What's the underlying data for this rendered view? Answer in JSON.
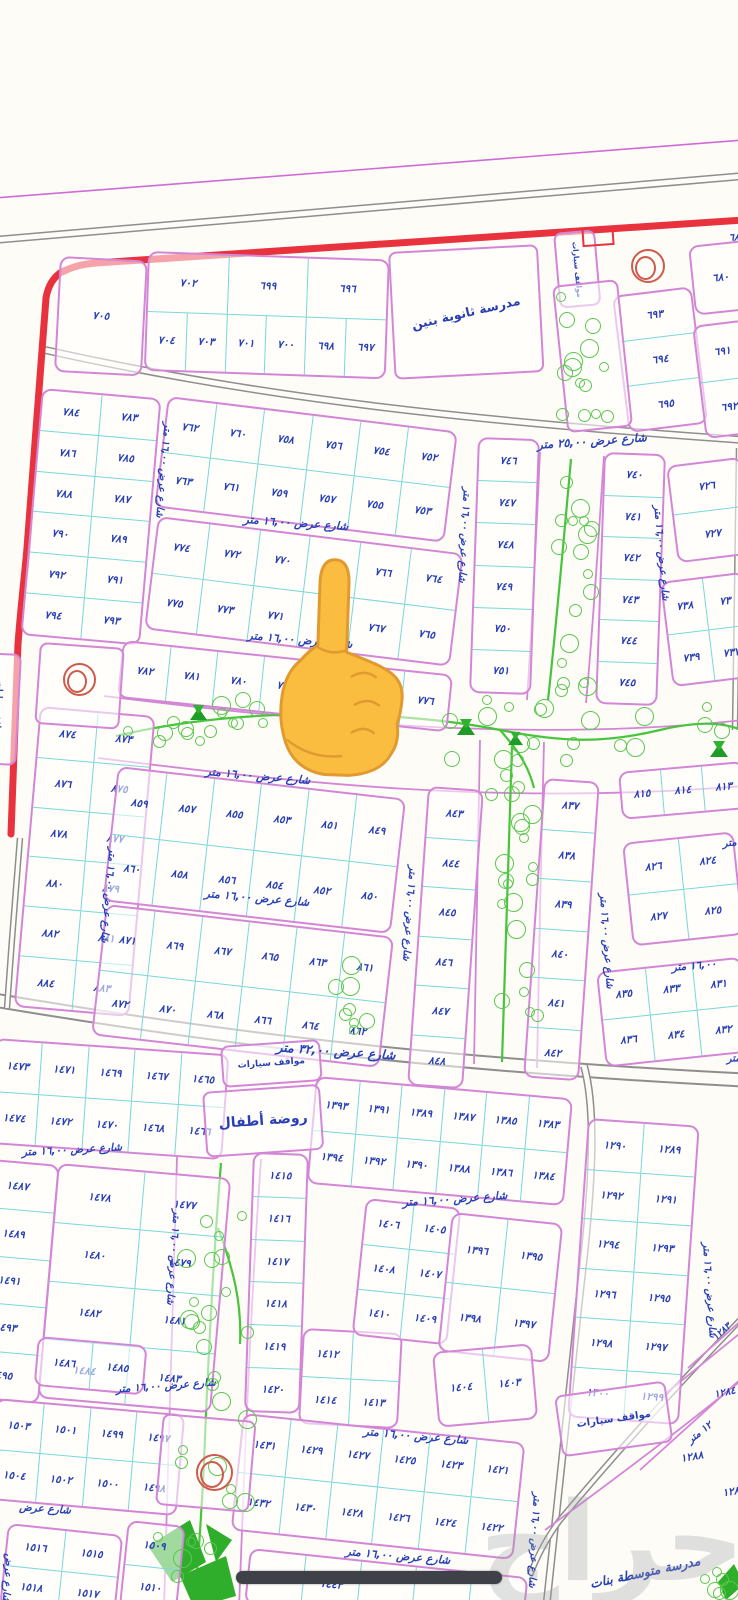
{
  "colors": {
    "plot_border_pink": "#d486d6",
    "subdivision_cyan": "#79d7d9",
    "ink_blue": "#2940b4",
    "boundary_red": "#e8323e",
    "road_gray": "#8e8e8e",
    "tree_green": "#5bc74f",
    "park_green": "#47c43c",
    "roundabout_red": "#cd5a4b",
    "background": "#fefcf7",
    "progress_bar": "#3e4147",
    "finger_yellow": "#fbbd3f"
  },
  "blocks": [
    {
      "id": "705",
      "x": 60,
      "y": 256,
      "w": 88,
      "h": 116,
      "rot": 3,
      "rows": [
        [
          "٧٠٥"
        ]
      ]
    },
    {
      "id": "696-704",
      "x": 148,
      "y": 251,
      "w": 242,
      "h": 120,
      "rot": 2,
      "rows": [
        [
          "٧٠٢",
          "٦٩٩",
          "٦٩٦"
        ],
        [
          "٧٠٤",
          "٧٠٣",
          "٧٠١",
          "٧٠٠",
          "٦٩٨",
          "٦٩٧"
        ]
      ]
    },
    {
      "id": "680",
      "x": 688,
      "y": 246,
      "w": 58,
      "h": 70,
      "rot": -6,
      "rows": [
        [
          "٦٨٠"
        ]
      ]
    },
    {
      "id": "693-695",
      "x": 612,
      "y": 296,
      "w": 80,
      "h": 138,
      "rot": -7,
      "rows": [
        [
          "٦٩٣"
        ],
        [
          "٦٩٤"
        ],
        [
          "٦٩٥"
        ]
      ]
    },
    {
      "id": "691-692",
      "x": 692,
      "y": 326,
      "w": 54,
      "h": 114,
      "rot": -7,
      "rows": [
        [
          "٦٩١"
        ],
        [
          "٦٩٢"
        ]
      ]
    },
    {
      "id": "783-794",
      "x": 42,
      "y": 388,
      "w": 120,
      "h": 248,
      "rot": 5,
      "rows": [
        [
          "٧٨٤",
          "٧٨٣"
        ],
        [
          "٧٨٦",
          "٧٨٥"
        ],
        [
          "٧٨٨",
          "٧٨٧"
        ],
        [
          "٧٩٠",
          "٧٨٩"
        ],
        [
          "٧٩٢",
          "٧٩١"
        ],
        [
          "٧٩٤",
          "٧٩٣"
        ]
      ]
    },
    {
      "id": "752-763",
      "x": 168,
      "y": 396,
      "w": 292,
      "h": 112,
      "rot": 7,
      "rows": [
        [
          "٧٦٢",
          "٧٦٠",
          "٧٥٨",
          "٧٥٦",
          "٧٥٤",
          "٧٥٢"
        ],
        [
          "٧٦٣",
          "٧٦١",
          "٧٥٩",
          "٧٥٧",
          "٧٥٥",
          "٧٥٣"
        ]
      ]
    },
    {
      "id": "764-775",
      "x": 158,
      "y": 516,
      "w": 308,
      "h": 114,
      "rot": 7,
      "rows": [
        [
          "٧٧٤",
          "٧٧٢",
          "٧٧٠",
          "٧٦٨",
          "٧٦٦",
          "٧٦٤"
        ],
        [
          "٧٧٥",
          "٧٧٣",
          "٧٧١",
          "",
          "٧٦٧",
          "٧٦٥"
        ]
      ]
    },
    {
      "id": "776-782",
      "x": 123,
      "y": 640,
      "w": 332,
      "h": 58,
      "rot": 6,
      "rows": [
        [
          "٧٨٢",
          "٧٨١",
          "٧٨٠",
          "٧٧٩",
          "",
          "",
          "٧٧٦"
        ]
      ]
    },
    {
      "id": "746-751",
      "x": 478,
      "y": 437,
      "w": 62,
      "h": 256,
      "rot": 2,
      "rows": [
        [
          "٧٤٦"
        ],
        [
          "٧٤٧"
        ],
        [
          "٧٤٨"
        ],
        [
          "٧٤٩"
        ],
        [
          "٧٥٠"
        ],
        [
          "٧٥١"
        ]
      ]
    },
    {
      "id": "740-745",
      "x": 604,
      "y": 452,
      "w": 62,
      "h": 252,
      "rot": 2,
      "rows": [
        [
          "٧٤٠"
        ],
        [
          "٧٤١"
        ],
        [
          "٧٤٢"
        ],
        [
          "٧٤٣"
        ],
        [
          "٧٤٤"
        ],
        [
          "٧٤٥"
        ]
      ]
    },
    {
      "id": "726-727",
      "x": 666,
      "y": 466,
      "w": 76,
      "h": 98,
      "rot": -7,
      "rows": [
        [
          "٧٢٦"
        ],
        [
          "٧٢٧"
        ]
      ]
    },
    {
      "id": "737-739",
      "x": 660,
      "y": 582,
      "w": 84,
      "h": 106,
      "rot": -7,
      "rows": [
        [
          "٧٣٨",
          "٧٣"
        ],
        [
          "٧٣٩",
          "٧٣٧"
        ]
      ]
    },
    {
      "id": "873-884",
      "x": 40,
      "y": 706,
      "w": 116,
      "h": 302,
      "rot": 5,
      "rows": [
        [
          "٨٧٤",
          "٨٧٣"
        ],
        [
          "٨٧٦",
          "٨٧٥"
        ],
        [
          "٨٧٨",
          "٨٧٧"
        ],
        [
          "٨٨٠",
          "٨٧٩"
        ],
        [
          "٨٨٢",
          "٨٨١"
        ],
        [
          "٨٨٤",
          "٨٨٣"
        ]
      ]
    },
    {
      "id": "849-860",
      "x": 118,
      "y": 766,
      "w": 290,
      "h": 136,
      "rot": 6.5,
      "rows": [
        [
          "٨٥٩",
          "٨٥٧",
          "٨٥٥",
          "٨٥٣",
          "٨٥١",
          "٨٤٩"
        ],
        [
          "٨٦٠",
          "٨٥٨",
          "٨٥٦",
          "٨٥٤",
          "٨٥٢",
          "٨٥٠"
        ]
      ]
    },
    {
      "id": "861-872",
      "x": 106,
      "y": 904,
      "w": 290,
      "h": 132,
      "rot": 6.5,
      "rows": [
        [
          "٨٧١",
          "٨٦٩",
          "٨٦٧",
          "٨٦٥",
          "٨٦٣",
          "٨٦١"
        ],
        [
          "٨٧٢",
          "٨٧٠",
          "٨٦٨",
          "٨٦٦",
          "٨٦٤",
          "٨٦٢"
        ]
      ]
    },
    {
      "id": "843-848",
      "x": 428,
      "y": 786,
      "w": 56,
      "h": 300,
      "rot": 4,
      "rows": [
        [
          "٨٤٣"
        ],
        [
          "٨٤٤"
        ],
        [
          "٨٤٥"
        ],
        [
          "٨٤٦"
        ],
        [
          "٨٤٧"
        ],
        [
          "٨٤٨"
        ]
      ]
    },
    {
      "id": "837-842",
      "x": 544,
      "y": 778,
      "w": 56,
      "h": 300,
      "rot": 4,
      "rows": [
        [
          "٨٣٧"
        ],
        [
          "٨٣٨"
        ],
        [
          "٨٣٩"
        ],
        [
          "٨٤٠"
        ],
        [
          "٨٤١"
        ],
        [
          "٨٤٢"
        ]
      ]
    },
    {
      "id": "813-815",
      "x": 618,
      "y": 772,
      "w": 126,
      "h": 48,
      "rot": -5,
      "rows": [
        [
          "٨١٥",
          "٨١٤",
          "٨١٣"
        ]
      ]
    },
    {
      "id": "824-827",
      "x": 622,
      "y": 843,
      "w": 112,
      "h": 104,
      "rot": -6,
      "rows": [
        [
          "٨٢٦",
          "٨٢٤"
        ],
        [
          "٨٢٧",
          "٨٢٥"
        ]
      ]
    },
    {
      "id": "831-836",
      "x": 596,
      "y": 972,
      "w": 146,
      "h": 96,
      "rot": -6,
      "rows": [
        [
          "٨٣٥",
          "٨٣٣",
          "٨٣١"
        ],
        [
          "٨٣٦",
          "٨٣٤",
          "٨٣٢"
        ]
      ]
    },
    {
      "id": "1465-1474",
      "x": -5,
      "y": 1038,
      "w": 235,
      "h": 106,
      "rot": 4,
      "rows": [
        [
          "١٤٧٣",
          "١٤٧١",
          "١٤٦٩",
          "١٤٦٧",
          "١٤٦٥"
        ],
        [
          "١٤٧٤",
          "١٤٧٢",
          "١٤٧٠",
          "١٤٦٨",
          "١٤٦٦"
        ]
      ]
    },
    {
      "id": "1383-1394",
      "x": 316,
      "y": 1076,
      "w": 258,
      "h": 108,
      "rot": 5,
      "rows": [
        [
          "١٣٩٣",
          "١٣٩١",
          "١٣٨٩",
          "١٣٨٧",
          "١٣٨٥",
          "١٣٨٣"
        ],
        [
          "١٣٩٤",
          "١٣٩٢",
          "١٣٩٠",
          "١٣٨٨",
          "١٣٨٦",
          "١٣٨٤"
        ]
      ]
    },
    {
      "id": "1487-1495",
      "x": -20,
      "y": 1158,
      "w": 80,
      "h": 240,
      "rot": 5,
      "rows": [
        [
          "١٤٨٧"
        ],
        [
          "١٤٨٩"
        ],
        [
          "١٤٩١"
        ],
        [
          "١٤٩٣"
        ],
        [
          "١٤٩٥"
        ]
      ]
    },
    {
      "id": "1477-1484",
      "x": 58,
      "y": 1163,
      "w": 174,
      "h": 236,
      "rot": 5,
      "rows": [
        [
          "١٤٧٨",
          "١٤٧٧"
        ],
        [
          "١٤٨٠",
          "١٤٧٩"
        ],
        [
          "١٤٨٢",
          "١٤٨١"
        ],
        [
          "١٤٨٤",
          "١٤٨٣"
        ]
      ]
    },
    {
      "id": "1415-1420",
      "x": 253,
      "y": 1152,
      "w": 56,
      "h": 260,
      "rot": 2,
      "rows": [
        [
          "١٤١٥"
        ],
        [
          "١٤١٦"
        ],
        [
          "١٤١٧"
        ],
        [
          "١٤١٨"
        ],
        [
          "١٤١٩"
        ],
        [
          "١٤٢٠"
        ]
      ]
    },
    {
      "id": "1412-1414",
      "x": 303,
      "y": 1328,
      "w": 100,
      "h": 96,
      "rot": 3,
      "rows": [
        [
          "١٤١٢",
          ""
        ],
        [
          "١٤١٤",
          "١٤١٣"
        ]
      ]
    },
    {
      "id": "1405-1410",
      "x": 366,
      "y": 1198,
      "w": 96,
      "h": 138,
      "rot": 6,
      "rows": [
        [
          "١٤٠٦",
          "١٤٠٥"
        ],
        [
          "١٤٠٨",
          "١٤٠٧"
        ],
        [
          "١٤١٠",
          "١٤٠٩"
        ]
      ]
    },
    {
      "id": "1395-1398",
      "x": 452,
      "y": 1212,
      "w": 112,
      "h": 140,
      "rot": 6,
      "rows": [
        [
          "١٣٩٦",
          "١٣٩٥"
        ],
        [
          "١٣٩٨",
          "١٣٩٧"
        ]
      ]
    },
    {
      "id": "1403-1404",
      "x": 432,
      "y": 1352,
      "w": 100,
      "h": 76,
      "rot": -5,
      "rows": [
        [
          "١٤٠٤",
          "١٤٠٣"
        ]
      ]
    },
    {
      "id": "1289-1300",
      "x": 588,
      "y": 1118,
      "w": 112,
      "h": 300,
      "rot": 4,
      "rows": [
        [
          "١٢٩٠",
          "١٢٨٩"
        ],
        [
          "١٢٩٢",
          "١٢٩١"
        ],
        [
          "١٢٩٤",
          "١٢٩٣"
        ],
        [
          "١٢٩٦",
          "١٢٩٥"
        ],
        [
          "١٢٩٨",
          "١٢٩٧"
        ],
        [
          "١٣٠٠",
          "١٢٩٩"
        ]
      ]
    },
    {
      "id": "1421-1432",
      "x": 243,
      "y": 1413,
      "w": 284,
      "h": 118,
      "rot": 6,
      "rows": [
        [
          "١٤٣١",
          "١٤٢٩",
          "١٤٢٧",
          "١٤٢٥",
          "١٤٢٣",
          "١٤٢١"
        ],
        [
          "١٤٣٢",
          "١٤٣٠",
          "١٤٢٨",
          "١٤٢٦",
          "١٤٢٤",
          "١٤٢٢"
        ]
      ]
    },
    {
      "id": "1485-1486",
      "x": 38,
      "y": 1336,
      "w": 110,
      "h": 50,
      "rot": 5,
      "rows": [
        [
          "١٤٨٦",
          "١٤٨٥"
        ]
      ]
    },
    {
      "id": "1497-1504",
      "x": -4,
      "y": 1398,
      "w": 190,
      "h": 102,
      "rot": 5,
      "rows": [
        [
          "١٥٠٣",
          "١٥٠١",
          "١٤٩٩",
          "١٤٩٧"
        ],
        [
          "١٥٠٤",
          "١٥٠٢",
          "١٥٠٠",
          "١٤٩٨"
        ]
      ]
    },
    {
      "id": "1515-1518",
      "x": 8,
      "y": 1523,
      "w": 116,
      "h": 84,
      "rot": 6,
      "rows": [
        [
          "١٥١٦",
          "١٥١٥"
        ],
        [
          "١٥١٨",
          "١٥١٧"
        ]
      ]
    },
    {
      "id": "1509-1510",
      "x": 128,
      "y": 1520,
      "w": 58,
      "h": 88,
      "rot": 6,
      "rows": [
        [
          "١٥٠٩"
        ],
        [
          "١٥١٠"
        ]
      ]
    },
    {
      "id": "1443-row",
      "x": 250,
      "y": 1548,
      "w": 280,
      "h": 56,
      "rot": 6,
      "rows": [
        [
          "",
          "١٤٤٣",
          "",
          "",
          ""
        ]
      ]
    }
  ],
  "plots": [
    {
      "id": "school-boys",
      "x": 388,
      "y": 252,
      "w": 150,
      "h": 128,
      "rot": -3,
      "label": "مدرسة ثانوية بنين",
      "fs": 12.5,
      "lrot": -10
    },
    {
      "id": "parking-top",
      "x": 553,
      "y": 233,
      "w": 42,
      "h": 76,
      "rot": -5,
      "label": "مواقف سيارات",
      "fs": 7.5,
      "v": true
    },
    {
      "id": "garden-top",
      "x": 552,
      "y": 286,
      "w": 66,
      "h": 148,
      "rot": -6
    },
    {
      "id": "parking-left",
      "x": -18,
      "y": 652,
      "w": 40,
      "h": 112,
      "rot": 3,
      "label": "مواقف سيارات",
      "fs": 7.5,
      "v": true
    },
    {
      "id": "roundabout-left-plot",
      "x": 40,
      "y": 642,
      "w": 85,
      "h": 82,
      "rot": 4
    },
    {
      "id": "parking-mid",
      "x": 220,
      "y": 1046,
      "w": 100,
      "h": 42,
      "rot": -4,
      "label": "مواقف سيارات",
      "fs": 9
    },
    {
      "id": "kindergarten",
      "x": 202,
      "y": 1092,
      "w": 118,
      "h": 66,
      "rot": -4,
      "label": "روضة أطفال",
      "fs": 14
    },
    {
      "id": "roundabout-bottom-plot",
      "x": 163,
      "y": 1413,
      "w": 94,
      "h": 92,
      "rot": 5
    },
    {
      "id": "parking-bottom-right",
      "x": 554,
      "y": 1396,
      "w": 112,
      "h": 62,
      "rot": -8,
      "label": "مواقف سيارات",
      "fs": 10
    }
  ],
  "labels": [
    {
      "t": "شارع عرض ٢٥,٠٠ متر",
      "x": 592,
      "y": 441,
      "rot": -4,
      "fs": 11.5
    },
    {
      "t": "شارع عرض ١٦,٠٠ متر",
      "x": 296,
      "y": 523,
      "rot": 4,
      "fs": 11
    },
    {
      "t": "شارع عرض ١٦,٠٠ متر",
      "x": 300,
      "y": 640,
      "rot": 5,
      "fs": 11
    },
    {
      "t": "شارع عرض ١٦,٠٠ متر",
      "x": 258,
      "y": 776,
      "rot": 5,
      "fs": 11
    },
    {
      "t": "شارع عرض ١٦,٠٠ متر",
      "x": 257,
      "y": 898,
      "rot": 5,
      "fs": 11
    },
    {
      "t": "شارع عرض ٣٢,٠٠ متر",
      "x": 336,
      "y": 1051,
      "rot": 4,
      "fs": 12.5
    },
    {
      "t": "شارع عرض ١٦,٠٠ متر",
      "x": 72,
      "y": 1150,
      "rot": -3,
      "fs": 10.5
    },
    {
      "t": "شارع عرض ١٦,٠٠ متر",
      "x": 455,
      "y": 1199,
      "rot": -4,
      "fs": 11
    },
    {
      "t": "شارع عرض ١٦,٠٠ متر",
      "x": 166,
      "y": 1386,
      "rot": -4,
      "fs": 10.5
    },
    {
      "t": "شارع عرض ١٦,٠٠ متر",
      "x": 416,
      "y": 1436,
      "rot": 5,
      "fs": 11
    },
    {
      "t": "شارع عرض ١٦,٠٠ متر",
      "x": 398,
      "y": 1556,
      "rot": 5,
      "fs": 11
    },
    {
      "t": "شارع عرض",
      "x": 45,
      "y": 1509,
      "rot": 4,
      "fs": 10.5
    },
    {
      "t": "١٢ متر",
      "x": 700,
      "y": 1433,
      "rot": -38,
      "fs": 10
    },
    {
      "t": "١٦,٠٠ متر",
      "x": 744,
      "y": 842,
      "rot": -6,
      "fs": 10
    },
    {
      "t": "١٦,٠٠ متر",
      "x": 694,
      "y": 966,
      "rot": -5,
      "fs": 10.5
    },
    {
      "t": "١٦,٠٠ متر",
      "x": 748,
      "y": 1058,
      "rot": -4,
      "fs": 10
    },
    {
      "t": "شارع عرض ١٦,٠٠ متر",
      "x": 163,
      "y": 470,
      "rot": 5,
      "fs": 10,
      "v": true
    },
    {
      "t": "شارع عرض ١٦,٠٠ متر",
      "x": 464,
      "y": 535,
      "rot": 3,
      "fs": 10,
      "v": true
    },
    {
      "t": "شارع عرض ١٦,٠٠ متر",
      "x": 661,
      "y": 553,
      "rot": -5,
      "fs": 10,
      "v": true
    },
    {
      "t": "شارع عرض ١٦,٠٠ متر",
      "x": 108,
      "y": 895,
      "rot": 5,
      "fs": 10,
      "v": true
    },
    {
      "t": "شارع عرض ١٦,٠٠ متر",
      "x": 409,
      "y": 913,
      "rot": 4,
      "fs": 10,
      "v": true
    },
    {
      "t": "شارع عرض ١٦,٠٠ متر",
      "x": 606,
      "y": 941,
      "rot": -4,
      "fs": 10,
      "v": true
    },
    {
      "t": "شارع عرض ١٦,٠٠ متر",
      "x": 173,
      "y": 1257,
      "rot": 4,
      "fs": 10,
      "v": true
    },
    {
      "t": "شارع عرض ١٦,٠٠ متر",
      "x": 709,
      "y": 1290,
      "rot": -4,
      "fs": 10,
      "v": true
    },
    {
      "t": "شارع عرض ١٦,٠٠ متر",
      "x": 534,
      "y": 1540,
      "rot": 3,
      "fs": 10,
      "v": true
    },
    {
      "t": "شارع عرض",
      "x": 7,
      "y": 1578,
      "rot": 4,
      "fs": 10,
      "v": true
    }
  ],
  "loose": [
    {
      "t": "١٢٨٣",
      "x": 722,
      "y": 1332,
      "rot": -42,
      "fs": 9.5,
      "n": "plot-number-1283"
    },
    {
      "t": "١٢٨٤",
      "x": 725,
      "y": 1393,
      "rot": -12,
      "fs": 10,
      "n": "plot-number-1284"
    },
    {
      "t": "١٢٨٨",
      "x": 692,
      "y": 1457,
      "rot": -10,
      "fs": 10.5,
      "n": "plot-number-1288"
    },
    {
      "t": "١٢٨",
      "x": 731,
      "y": 1492,
      "rot": -10,
      "fs": 10.5,
      "n": "plot-number-partial"
    },
    {
      "t": "٦٨",
      "x": 734,
      "y": 238,
      "rot": 0,
      "fs": 10,
      "n": "plot-number-partial"
    },
    {
      "t": "مدرسة متوسطة بنات",
      "x": 645,
      "y": 1572,
      "rot": -12,
      "fs": 12.5,
      "n": "girls-school-label"
    }
  ],
  "trees": [
    {
      "x": 556,
      "y": 292,
      "w": 60,
      "h": 138,
      "n": 14
    },
    {
      "x": 545,
      "y": 458,
      "w": 56,
      "h": 238,
      "n": 18
    },
    {
      "x": 112,
      "y": 692,
      "w": 624,
      "h": 78,
      "n": 40
    },
    {
      "x": 482,
      "y": 745,
      "w": 60,
      "h": 315,
      "n": 22
    },
    {
      "x": 328,
      "y": 950,
      "w": 46,
      "h": 88,
      "n": 8
    },
    {
      "x": 172,
      "y": 1162,
      "w": 88,
      "h": 348,
      "n": 24
    },
    {
      "x": 140,
      "y": 1522,
      "w": 92,
      "h": 78,
      "n": 6
    },
    {
      "x": 700,
      "y": 1544,
      "w": 38,
      "h": 56,
      "n": 6
    }
  ],
  "symbols": {
    "circles": [
      {
        "x": 631,
        "y": 249,
        "d": 30
      },
      {
        "x": 63,
        "y": 663,
        "d": 29
      },
      {
        "x": 196,
        "y": 1454,
        "d": 33
      }
    ],
    "play": [
      {
        "x": 190,
        "y": 704,
        "s": 17
      },
      {
        "x": 457,
        "y": 718,
        "s": 18
      },
      {
        "x": 508,
        "y": 731,
        "s": 15
      },
      {
        "x": 710,
        "y": 740,
        "s": 18
      }
    ],
    "gate": {
      "x": 582,
      "y": 227,
      "w": 28,
      "h": 15,
      "rot": -4
    }
  },
  "finger": {
    "glyph": "backhand-index-pointing-up"
  },
  "watermark": {
    "t": "حراج",
    "x": 612,
    "y": 1542,
    "fs": 110
  },
  "progress_bar": {
    "x": 236,
    "y": 1571,
    "w": 266,
    "h": 13
  }
}
